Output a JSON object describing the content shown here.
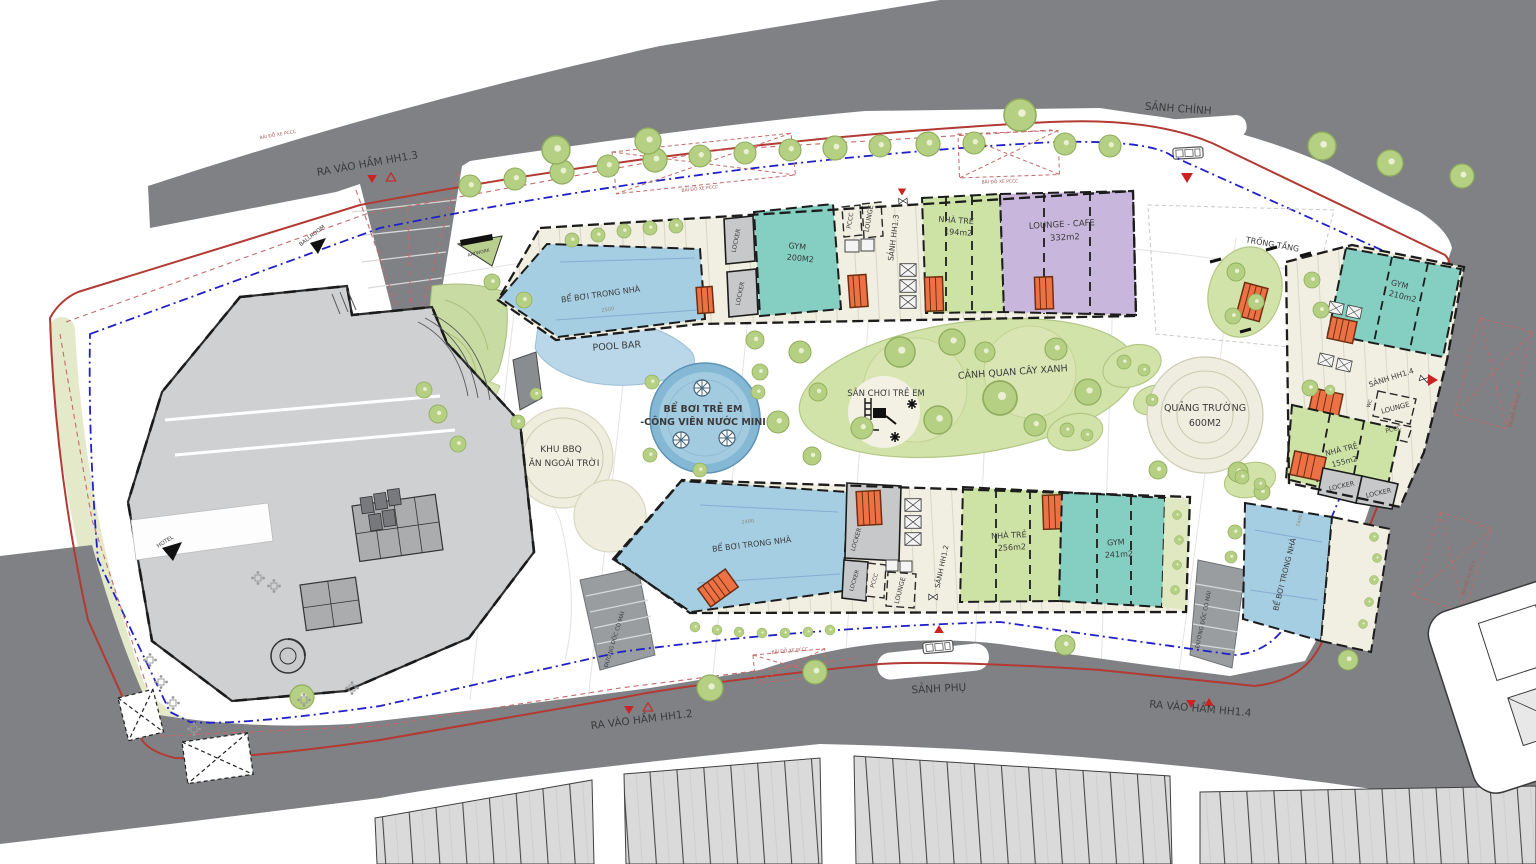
{
  "labels": {
    "entrances": {
      "basement_hh13": "RA VÀO HẦM HH1.3",
      "basement_hh12": "RA VÀO HẦM HH1.2",
      "basement_hh14": "RA VÀO HẦM HH1.4",
      "main_lobby": "SẢNH CHÍNH",
      "secondary_lobby": "SẢNH PHỤ",
      "hotel": "HOTEL",
      "ballroom": "BALLROOM"
    },
    "amenities": {
      "pool_bar": "POOL BAR",
      "kids_pool_line1": "BỂ BƠI TRẺ EM",
      "kids_pool_line2": "-CÔNG VIÊN NƯỚC MINI",
      "bbq_line1": "KHU BBQ",
      "bbq_line2": "- ĂN NGOÀI TRỜI",
      "playground": "SÂN CHƠI TRẺ EM",
      "green_landscape": "CẢNH QUAN CÂY XANH",
      "plaza_line1": "QUẢNG TRƯỜNG",
      "plaza_line2": "600M2",
      "void_space": "TRỐNG TẦNG",
      "artwork": "ARTWORK",
      "indoor_pool": "BỂ BƠI TRONG NHÀ",
      "covered_ramp": "ĐƯỜNG DỐC CÓ MÁI",
      "fire_truck_parking": "BÃI ĐỖ XE PCCC"
    },
    "block_hh13": {
      "gym": "GYM",
      "gym_area": "200M2",
      "nursery": "NHÀ TRẺ",
      "nursery_area": "194m2",
      "lounge_cafe": "LOUNGE - CAFE",
      "lounge_cafe_area": "332m2",
      "lobby": "SẢNH HH1.3",
      "lounge": "LOUNGE",
      "pccc": "PCCC",
      "locker": "LOCKER"
    },
    "block_hh12": {
      "gym": "GYM",
      "gym_area": "241m2",
      "nursery": "NHÀ TRẺ",
      "nursery_area": "256m2",
      "lobby": "SẢNH HH1.2",
      "lounge": "LOUNGE",
      "pccc": "PCCC",
      "locker": "LOCKER"
    },
    "block_hh14": {
      "gym": "GYM",
      "gym_area": "210m2",
      "nursery": "NHÀ TRẺ",
      "nursery_area": "155m2",
      "lobby": "SẢNH HH1.4",
      "lounge": "LOUNGE",
      "pccc": "PCCC",
      "locker": "LOCKER",
      "wc": "WC"
    },
    "dimensions": {
      "pool_top": "2500",
      "pool_bottom": "2400",
      "pool_right": "7400"
    }
  },
  "colors": {
    "road": "#7f8184",
    "gym": "#85cec2",
    "nursery": "#cde3a6",
    "lounge_cafe": "#c9b6dc",
    "pool": "#a6cee3",
    "kids_pool": "#84b8d5",
    "stair_core": "#ec7144",
    "tree": "#b6d083",
    "boundary_red": "#b23a33",
    "boundary_blue": "#2020c8"
  }
}
